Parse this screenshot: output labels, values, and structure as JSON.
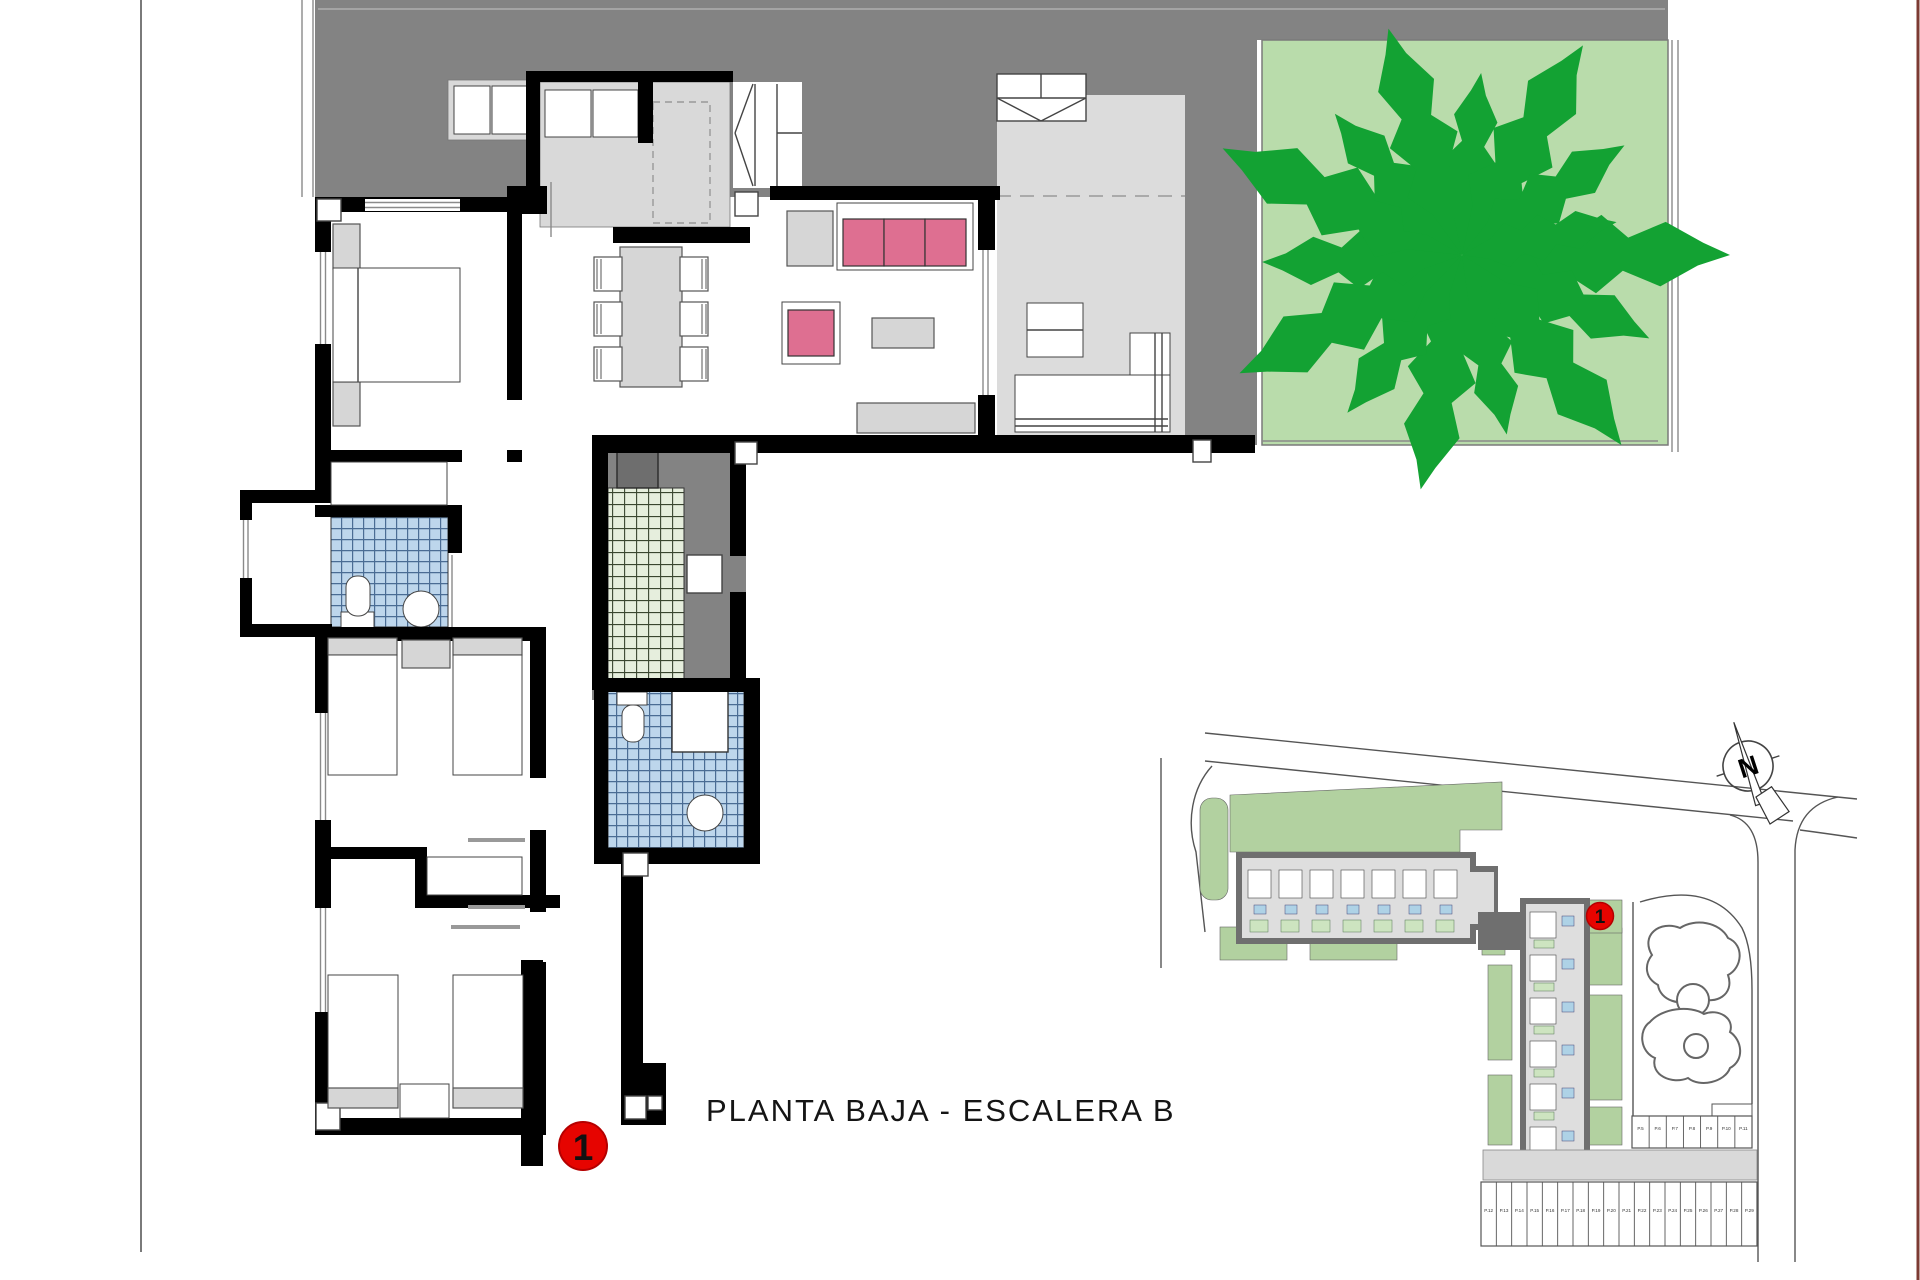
{
  "document": {
    "title_label": "PLANTA BAJA - ESCALERA B"
  },
  "unit_markers": {
    "floor_plan_unit": "1",
    "site_plan_unit": "1"
  },
  "compass": {
    "north_label": "N"
  },
  "site_plan": {
    "parking_row_right": [
      "P.5",
      "P.6",
      "P.7",
      "P.8",
      "P.9",
      "P.10",
      "P.11"
    ],
    "parking_row_bottom": [
      "P.12",
      "P.13",
      "P.14",
      "P.15",
      "P.16",
      "P.17",
      "P.18",
      "P.19",
      "P.20",
      "P.21",
      "P.22",
      "P.23",
      "P.24",
      "P.25",
      "P.26",
      "P.27",
      "P.28",
      "P.29"
    ]
  },
  "colors": {
    "terrace_gray": "#838383",
    "porch_gray": "#dcdcdc",
    "garden_green": "#b9dcab",
    "tree_green": "#13a233",
    "site_green": "#b2d1a0",
    "sofa_pink": "#de6f91",
    "bath_tile_blue": "#bdd6ec",
    "patio_tile_green": "#e6eedd",
    "marker_red": "#e60400",
    "wall_black": "#000000"
  }
}
